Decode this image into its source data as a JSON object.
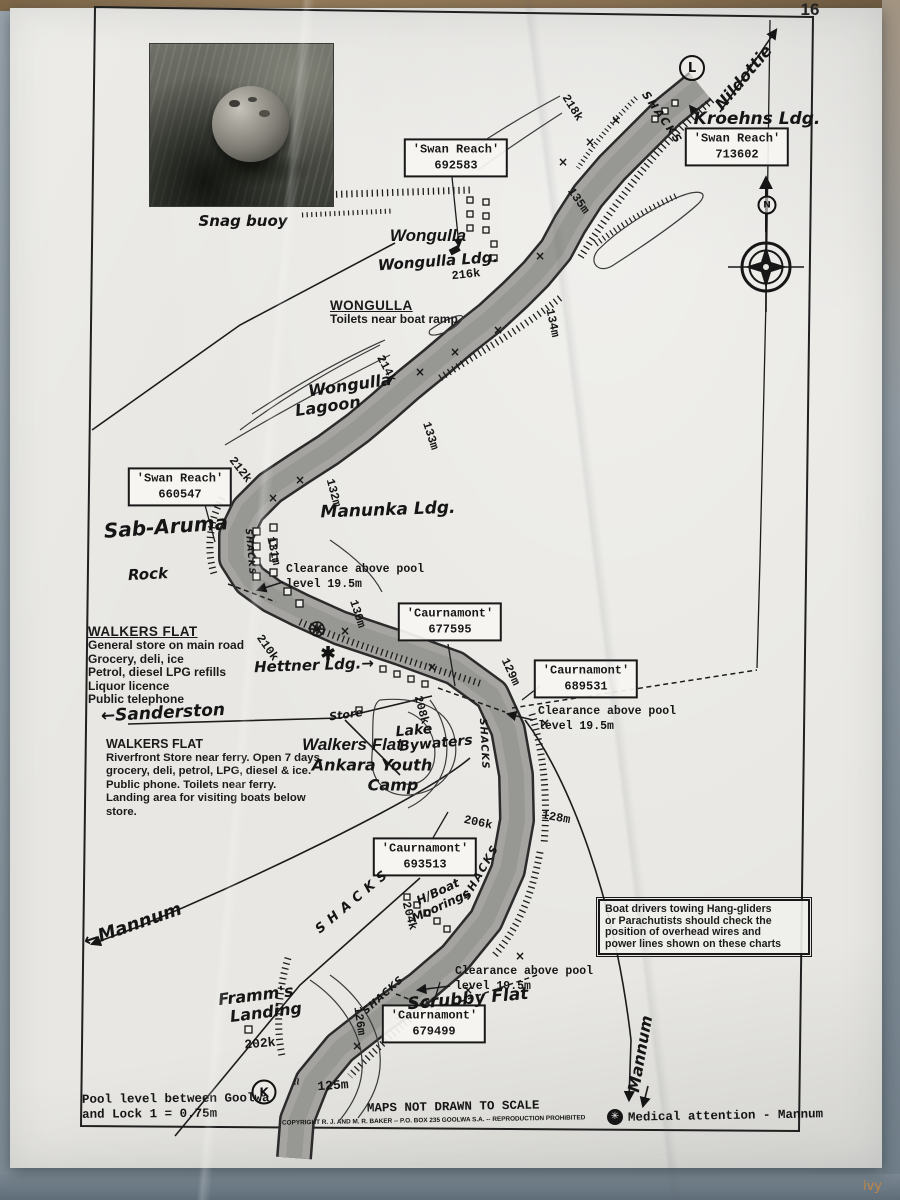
{
  "page": {
    "number": "16",
    "top_title": "WALKERS FLAT",
    "watermark": "ivy"
  },
  "photo": {
    "caption": "Snag buoy"
  },
  "nav_boxes": {
    "swan_reach_713602": {
      "name": "'Swan Reach'",
      "code": "713602"
    },
    "swan_reach_692583": {
      "name": "'Swan Reach'",
      "code": "692583"
    },
    "swan_reach_660547": {
      "name": "'Swan Reach'",
      "code": "660547"
    },
    "caurnamont_677595": {
      "name": "'Caurnamont'",
      "code": "677595"
    },
    "caurnamont_689531": {
      "name": "'Caurnamont'",
      "code": "689531"
    },
    "caurnamont_693513": {
      "name": "'Caurnamont'",
      "code": "693513"
    },
    "caurnamont_679499": {
      "name": "'Caurnamont'",
      "code": "679499"
    }
  },
  "info_blocks": {
    "wongulla": {
      "title": "WONGULLA",
      "lines": [
        "Toilets near boat ramp"
      ]
    },
    "walkers_flat_road": {
      "title": "WALKERS FLAT",
      "lines": [
        "General store on main road",
        "Grocery, deli, ice",
        "Petrol, diesel LPG refills",
        "Liquor licence",
        "Public telephone"
      ]
    },
    "walkers_flat_ferry": {
      "title": "WALKERS FLAT",
      "lines": [
        "Riverfront Store near ferry.  Open 7 days.",
        "grocery, deli, petrol, LPG, diesel & ice.",
        "Public phone.  Toilets near ferry.",
        "Landing area for visiting boats below",
        "store."
      ]
    },
    "warning": {
      "lines": [
        "Boat drivers towing Hang-gliders",
        "or Parachutists should check the",
        "position of overhead wires and",
        "power lines shown on these charts"
      ]
    }
  },
  "clearance_note": {
    "line1": "Clearance above pool",
    "line2": "level 19.5m"
  },
  "places": {
    "nildottie": "Nildottie",
    "kroehns": "Kroehns Ldg.",
    "wongulla_bold": "Wongulla",
    "wongulla_ldg": "Wongulla Ldg.",
    "lagoon_line1": "Wongulla",
    "lagoon_line2": "Lagoon",
    "sab_aruma": "Sab-Aruma",
    "manunka": "Manunka Ldg.",
    "rock": "Rock",
    "hettner": "Hettner Ldg.→",
    "sanderston": "←Sanderston",
    "store": "Store",
    "walkers_flat_bold": "Walkers Flat",
    "lake_line1": "Lake",
    "lake_line2": "Bywaters",
    "ankara_line1": "Ankara Youth",
    "ankara_line2": "Camp",
    "mannum_left": "←Mannum",
    "mannum_bottom": "Mannum",
    "framms_line1": "Framm's",
    "framms_line2": "Landing",
    "scrubby": "Scrubby Flat",
    "hboat_line1": "H/Boat",
    "hboat_line2": "Moorings",
    "shacks": "SHACKS"
  },
  "distances": {
    "218k": "218k",
    "216k": "216k",
    "214k": "214k",
    "212k": "212k",
    "210k": "210k",
    "208k": "208k",
    "206k": "206k",
    "204k": "204k",
    "202k": "202k"
  },
  "heights": {
    "135m": "135m",
    "134m": "134m",
    "133m": "133m",
    "132m": "132m",
    "131m": "131m",
    "130m": "130m",
    "129m": "129m",
    "128m": "128m",
    "126m": "126m",
    "125m": "125m"
  },
  "symbols": {
    "lock_upper": "L",
    "lock_lower": "K",
    "north": "N",
    "ferry_star": "✱",
    "medical_glyph": "✳"
  },
  "footer": {
    "pool_line1": "Pool level between Goolwa",
    "pool_line2": "and Lock 1 = 0.75m",
    "scale": "MAPS NOT DRAWN TO SCALE",
    "copyright": "COPYRIGHT R. J. AND M. R. BAKER -- P.O. BOX 235 GOOLWA S.A. -- REPRODUCTION PROHIBITED",
    "medical": "Medical attention - Mannum"
  }
}
